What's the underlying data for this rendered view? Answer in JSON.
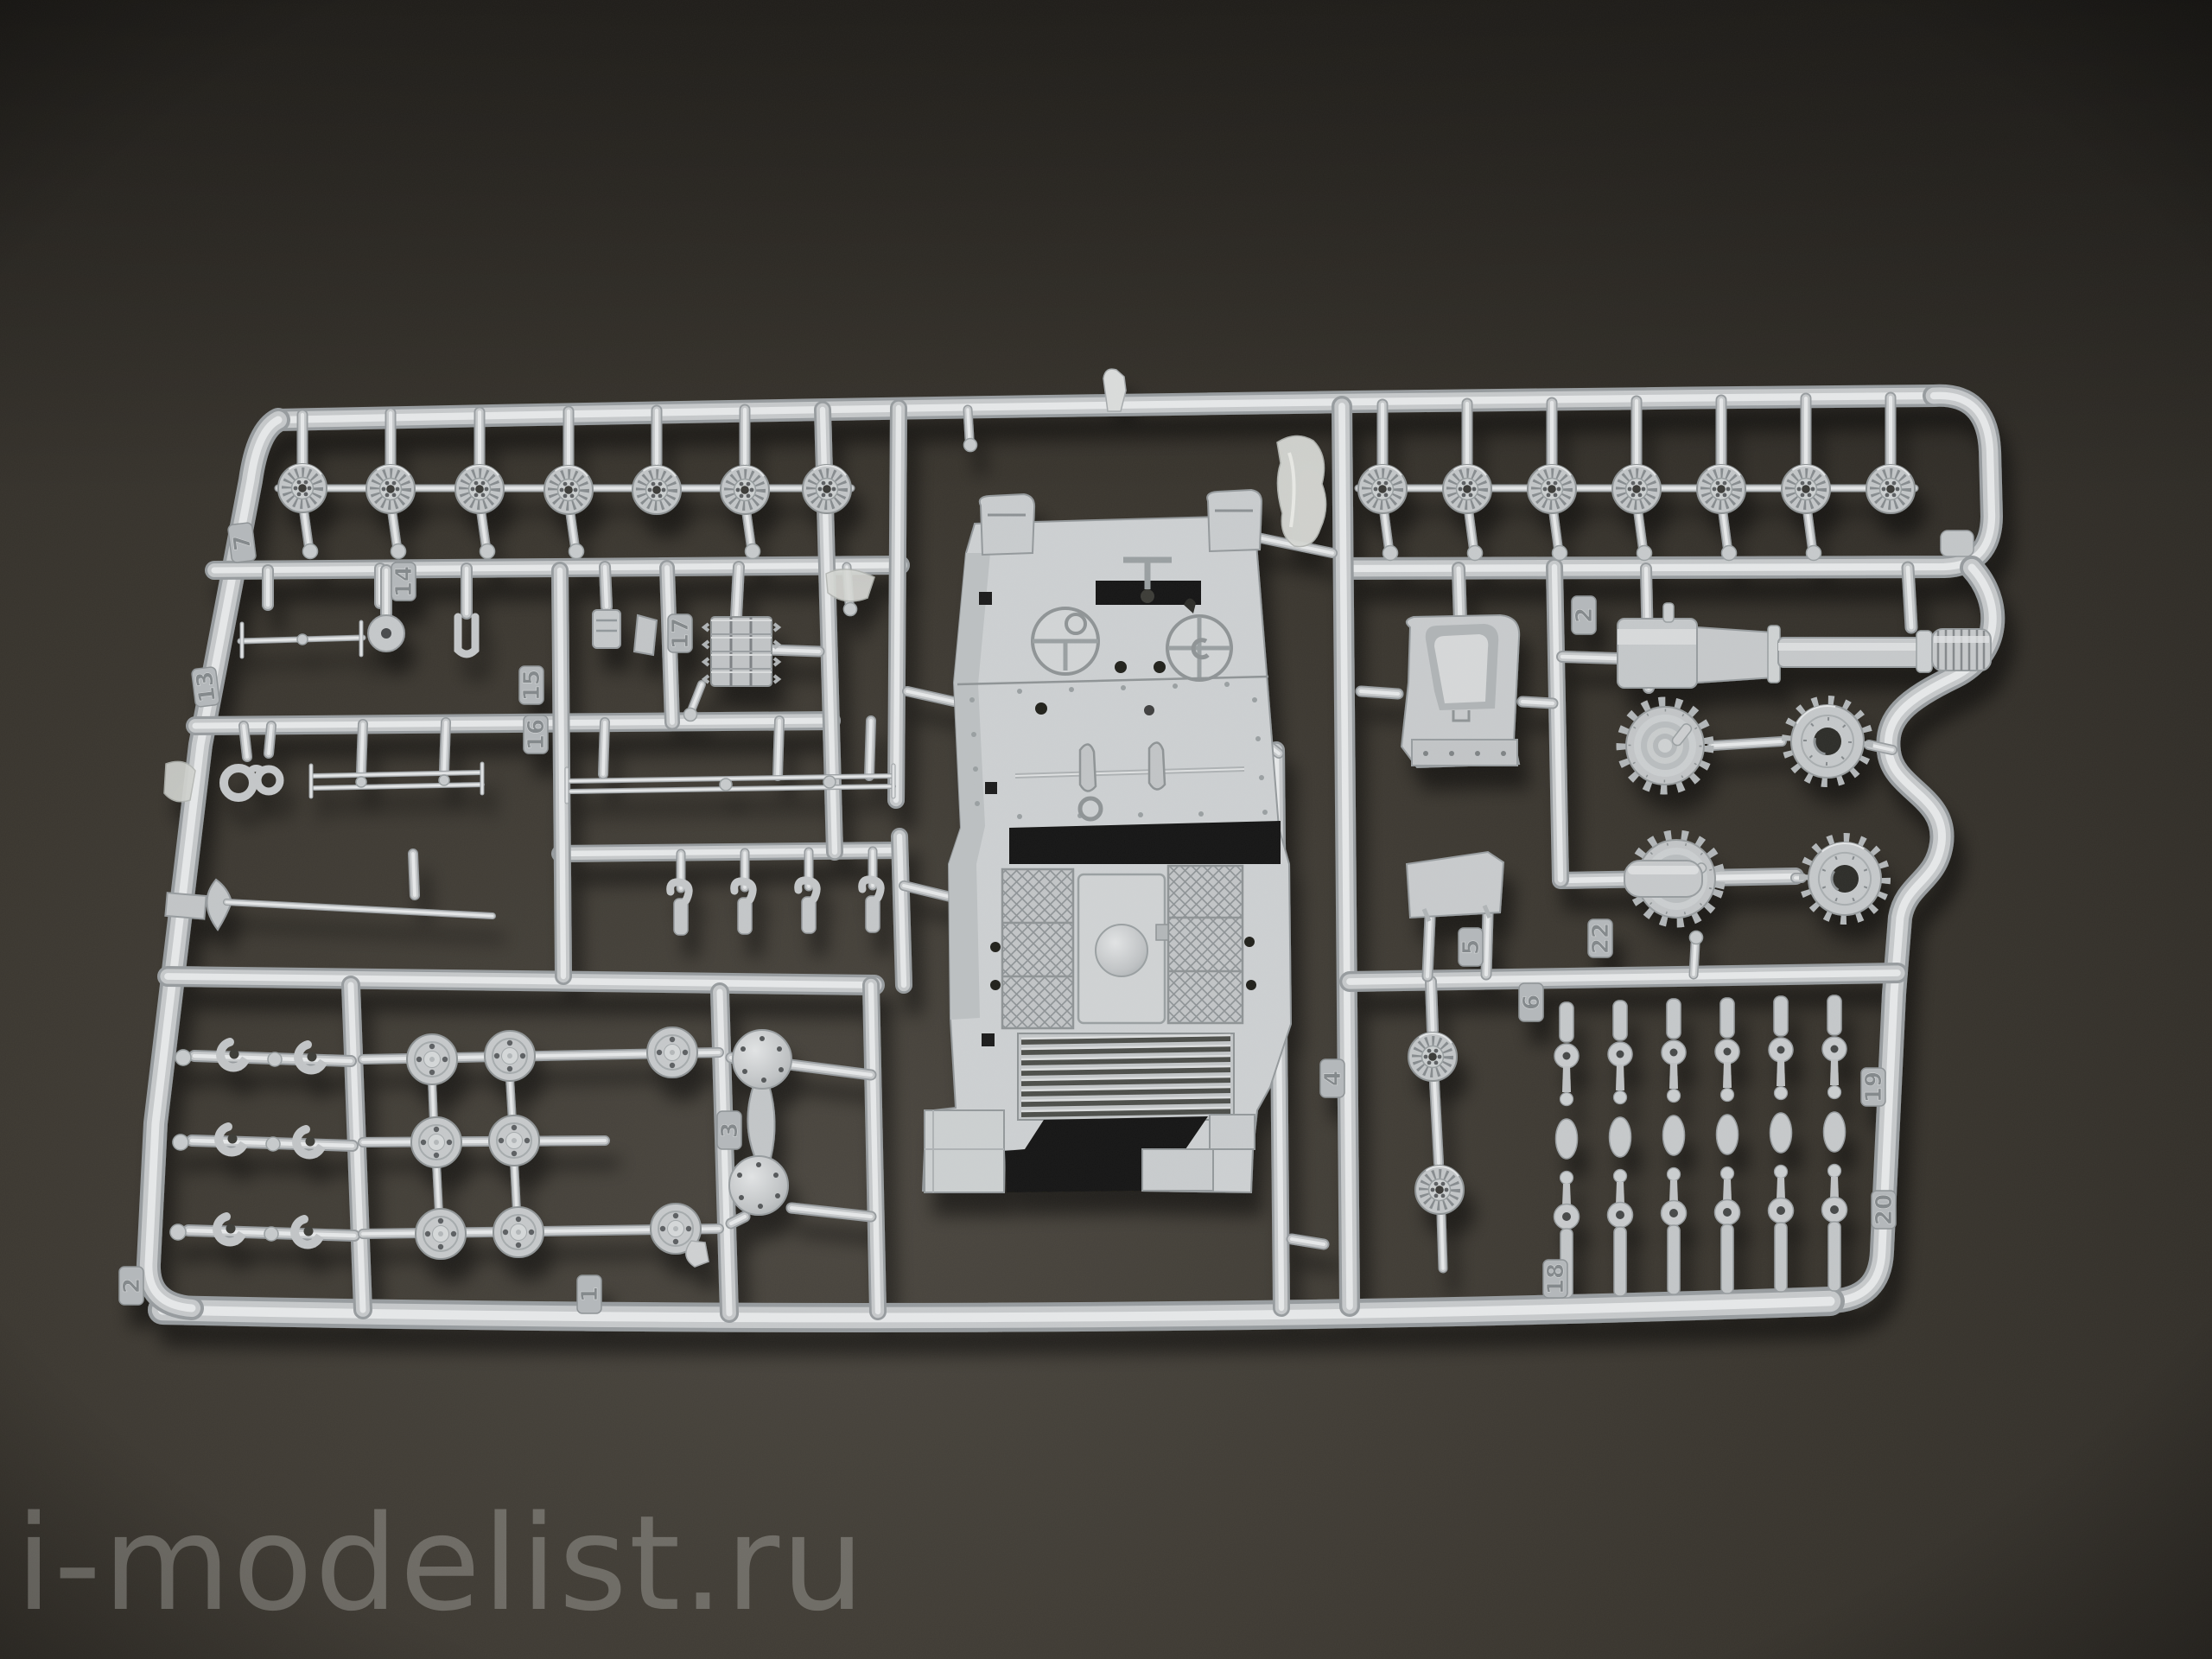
{
  "photo": {
    "subject": "plastic model kit sprue with tank parts on dark surface",
    "plastic_color": "#c6c9cb",
    "background_color": "#34312b",
    "shadow_color": "#0d0c0a"
  },
  "watermark": {
    "text": "i-modelist.ru"
  },
  "sprue": {
    "part_tabs": [
      {
        "label": "13"
      },
      {
        "label": "14"
      },
      {
        "label": "15"
      },
      {
        "label": "16"
      },
      {
        "label": "17"
      },
      {
        "label": "7"
      },
      {
        "label": "1"
      },
      {
        "label": "2"
      },
      {
        "label": "3"
      },
      {
        "label": "4"
      },
      {
        "label": "5"
      },
      {
        "label": "6"
      },
      {
        "label": "22"
      },
      {
        "label": "2"
      },
      {
        "label": "18"
      },
      {
        "label": "19"
      },
      {
        "label": "20"
      }
    ],
    "parts": [
      {
        "name": "road-wheel",
        "count": 14
      },
      {
        "name": "cone-drive-sprocket",
        "count": 2
      },
      {
        "name": "ring-idler-sprocket",
        "count": 2
      },
      {
        "name": "wheel-hub-disc",
        "count": 8
      },
      {
        "name": "suspension-arm-strip",
        "count": 6
      },
      {
        "name": "tank-upper-hull",
        "count": 1
      },
      {
        "name": "gun-barrel",
        "count": 1
      },
      {
        "name": "mantlet-saddle",
        "count": 1
      },
      {
        "name": "track-link-section",
        "count": 1
      },
      {
        "name": "tow-shackle",
        "count": 1
      },
      {
        "name": "pioneer-tool-pick",
        "count": 1
      },
      {
        "name": "cleaning-rod-set",
        "count": 2
      },
      {
        "name": "hull-dome",
        "count": 2
      },
      {
        "name": "tow-hook",
        "count": 6
      },
      {
        "name": "periscope",
        "count": 4
      }
    ]
  }
}
